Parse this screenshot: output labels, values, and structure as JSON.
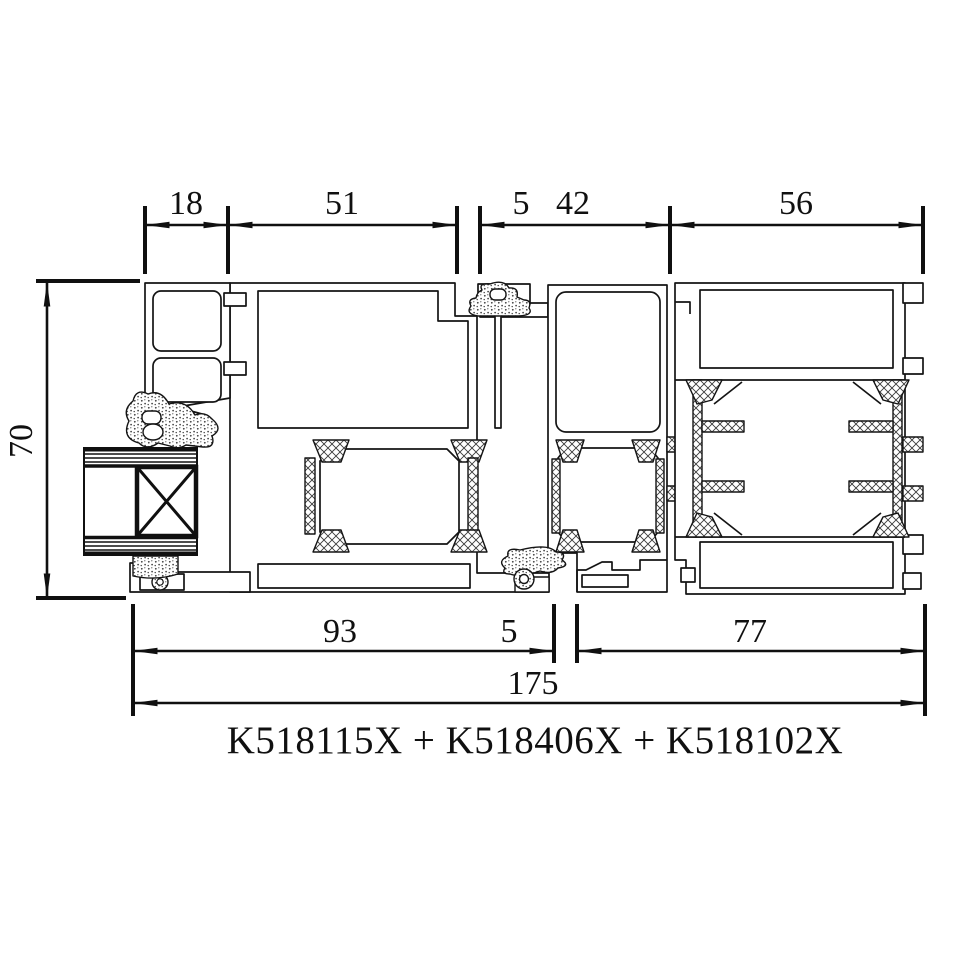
{
  "title": {
    "text": "K518115X + K518406X + K518102X",
    "profile_codes": [
      "K518115X",
      "K518406X",
      "K518102X"
    ]
  },
  "dimensions": {
    "top": [
      {
        "label": "18"
      },
      {
        "label": "51"
      },
      {
        "label": "5"
      },
      {
        "label": "42"
      },
      {
        "label": "56"
      }
    ],
    "left": [
      {
        "label": "70"
      }
    ],
    "bottom": [
      {
        "label": "93"
      },
      {
        "label": "5"
      },
      {
        "label": "77"
      },
      {
        "label": "175"
      }
    ]
  },
  "colors": {
    "line": "#141414",
    "background": "#ffffff"
  }
}
